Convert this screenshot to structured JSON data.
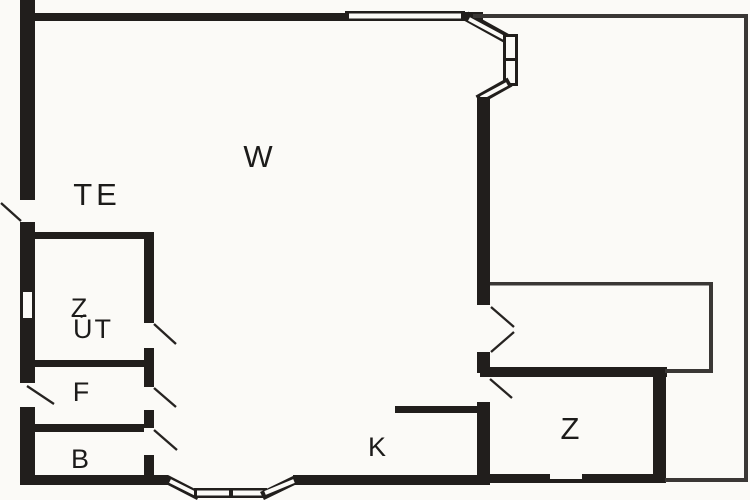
{
  "floorplan": {
    "type": "floorplan",
    "background_color": "#fbfaf7",
    "wall_color": "#211e1c",
    "thin_wall_color": "#3a3735",
    "label_color": "#1c1b1a",
    "rooms": [
      {
        "id": "w",
        "label": "W"
      },
      {
        "id": "te",
        "label": "TE"
      },
      {
        "id": "z-upper",
        "label": "Z"
      },
      {
        "id": "ut",
        "label": "ÚT"
      },
      {
        "id": "f",
        "label": "F"
      },
      {
        "id": "b",
        "label": "B"
      },
      {
        "id": "k",
        "label": "K"
      },
      {
        "id": "z-lower",
        "label": "Z"
      }
    ]
  }
}
